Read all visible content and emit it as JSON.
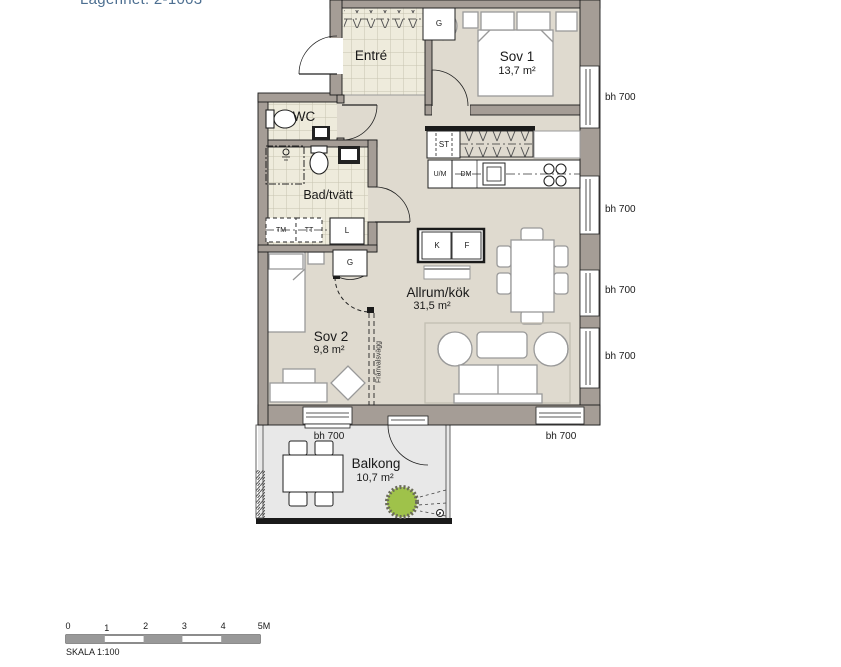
{
  "title": "Lägenhet: 2-1003",
  "rooms": {
    "entre": {
      "name": "Entré"
    },
    "sov1": {
      "name": "Sov 1",
      "area": "13,7 m²"
    },
    "wc": {
      "name": "WC"
    },
    "bad": {
      "name": "Bad/tvätt"
    },
    "allrum": {
      "name": "Allrum/kök",
      "area": "31,5 m²"
    },
    "sov2": {
      "name": "Sov 2",
      "area": "9,8 m²"
    },
    "balkong": {
      "name": "Balkong",
      "area": "10,7 m²"
    }
  },
  "fixtures": {
    "g_entre": "G",
    "g_sov2": "G",
    "st": "ST",
    "um": "U/M",
    "dm": "DM",
    "k": "K",
    "f": "F",
    "tm": "TM",
    "tt": "TT",
    "l": "L"
  },
  "sill_labels": {
    "right_1": "bh 700",
    "right_2": "bh 700",
    "right_3": "bh 700",
    "right_4": "bh 700",
    "bottom_balcony": "bh 700",
    "bottom_living": "bh 700"
  },
  "annotations": {
    "optional_wall": "Frånvalsvägg"
  },
  "scalebar": {
    "ticks": [
      "0",
      "1",
      "2",
      "3",
      "4",
      "5M"
    ],
    "caption": "SKALA 1:100"
  },
  "colors": {
    "wall": "#a59d96",
    "floor": "#dfdacf",
    "tile": "#eeebdc",
    "balcony_floor": "#e8e8e8",
    "bush": "#9fc24a",
    "title_text": "#4d6f91",
    "scalebar_fill": "#999999"
  }
}
